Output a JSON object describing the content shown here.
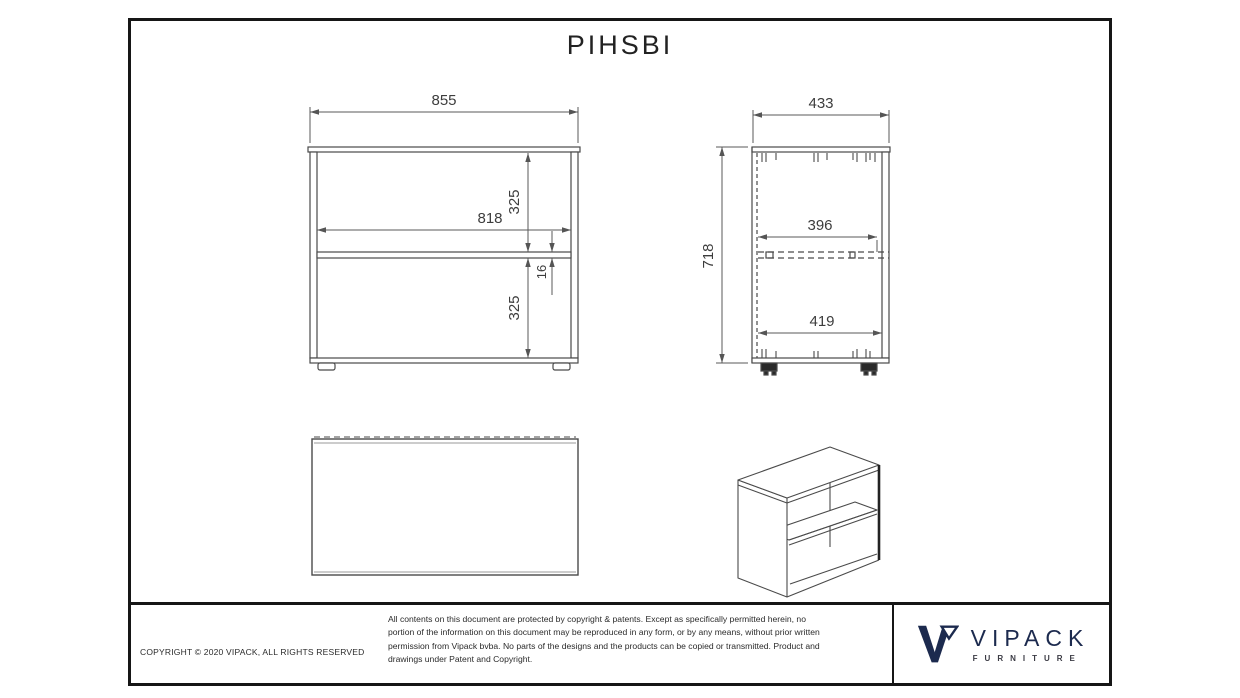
{
  "page": {
    "title": "PIHSBI"
  },
  "dimensions": {
    "front_width": "855",
    "front_inner_width": "818",
    "front_upper_opening": "325",
    "shelf_thickness": "16",
    "front_lower_opening": "325",
    "side_depth": "433",
    "side_height": "718",
    "shelf_depth": "396",
    "side_bottom_depth": "419"
  },
  "title_block": {
    "copyright": "COPYRIGHT  © 2020 VIPACK, ALL RIGHTS RESERVED",
    "disclaimer": "All contents on this document are protected by copyright & patents. Except as specifically permitted herein, no portion of the information on this document may be reproduced in any form, or by any means, without prior written permission from Vipack bvba. No parts of the designs and the products can be copied or transmitted. Product and drawings under Patent and Copyright.",
    "brand_name": "VIPACK",
    "brand_tagline": "FURNITURE"
  },
  "colors": {
    "line": "#4a4a4a",
    "dimension": "#555555",
    "brand_navy": "#1c2a4e",
    "frame": "#161616"
  }
}
